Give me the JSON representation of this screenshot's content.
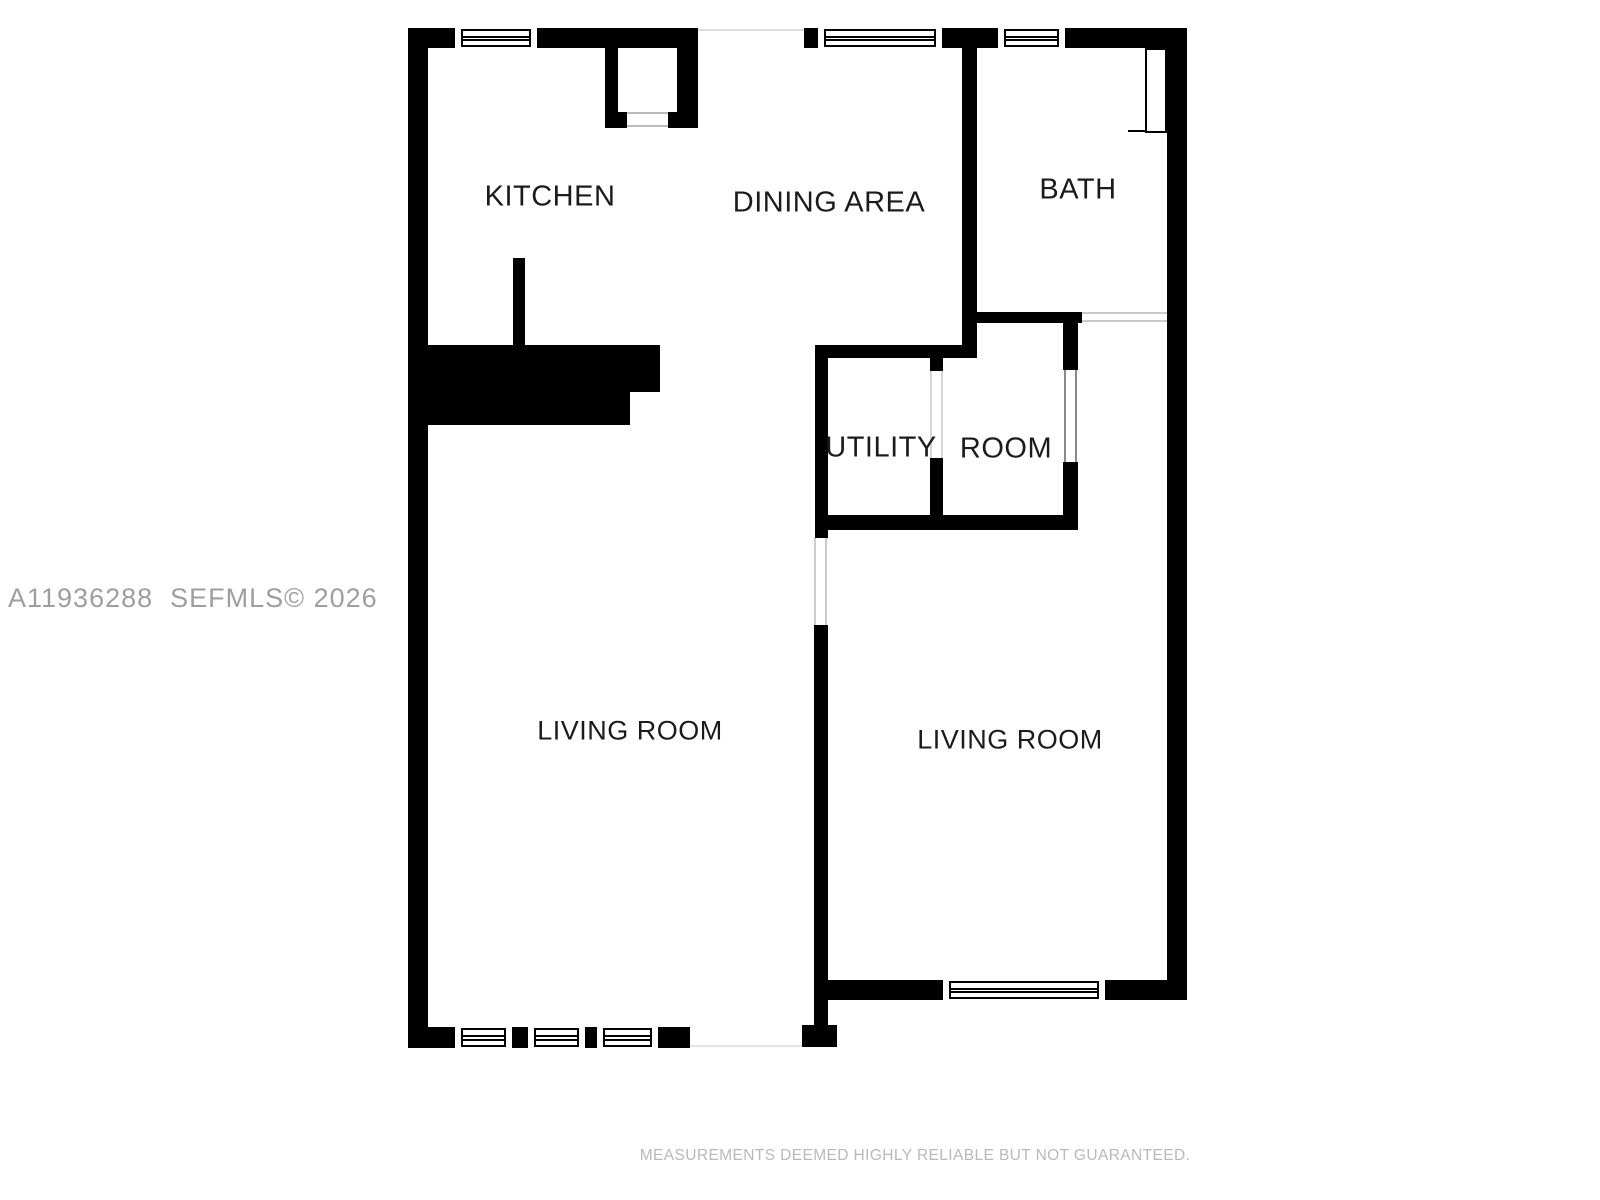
{
  "rooms": {
    "kitchen": {
      "label": "KITCHEN"
    },
    "dining": {
      "label": "DINING AREA"
    },
    "bath": {
      "label": "BATH"
    },
    "utility": {
      "label": "UTILITY"
    },
    "room": {
      "label": "ROOM"
    },
    "living_left": {
      "label": "LIVING ROOM"
    },
    "living_right": {
      "label": "LIVING ROOM"
    }
  },
  "watermark": {
    "text": "A11936288  SEFMLS© 2026"
  },
  "disclaimer": {
    "text": "MEASUREMENTS DEEMED HIGHLY RELIABLE BUT NOT GUARANTEED."
  },
  "colors": {
    "wall": "#000000",
    "background": "#ffffff",
    "label": "#1b1b1b",
    "watermark": "#9e9e9e",
    "disclaimer": "#b9b9b9"
  }
}
